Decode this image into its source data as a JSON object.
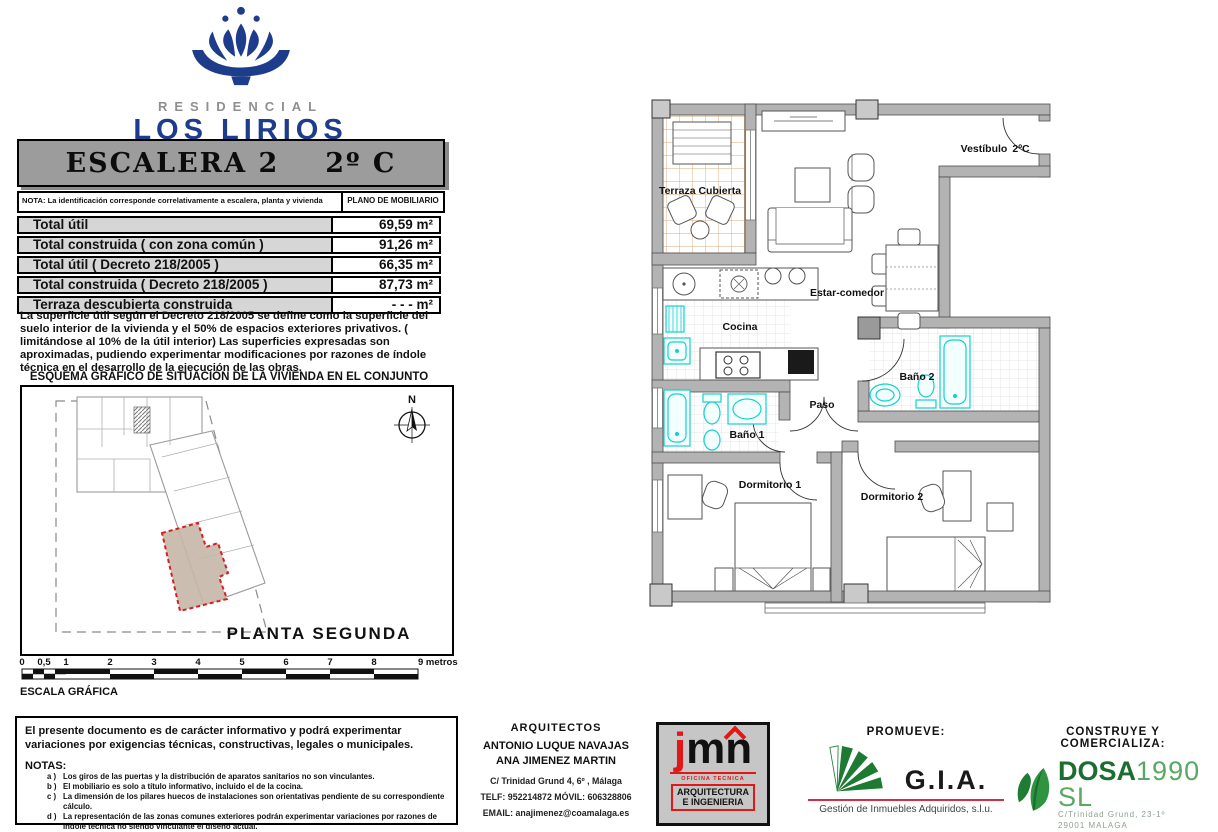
{
  "brand": {
    "line1": "RESIDENCIAL",
    "line2": "LOS LIRIOS"
  },
  "header": {
    "escalera": "ESCALERA 2",
    "unidad": "2º C"
  },
  "nota_bar": {
    "nota": "NOTA: La identificación corresponde correlativamente a escalera, planta y vivienda",
    "plano": "PLANO DE MOBILIARIO"
  },
  "areas": {
    "rows": [
      {
        "label": "Total útil",
        "value": "69,59 m²"
      },
      {
        "label": "Total construida  ( con zona común )",
        "value": "91,26 m²"
      },
      {
        "label": "Total útil  ( Decreto 218/2005 )",
        "value": "66,35 m²"
      },
      {
        "label": "Total construida  ( Decreto 218/2005 )",
        "value": "87,73 m²"
      },
      {
        "label": "Terraza descubierta construida",
        "value": "- - - m²"
      }
    ]
  },
  "description": "La superficie útil según el Decreto 218/2005 se define como la superficie del suelo interior de la vivienda y el 50% de espacios exteriores privativos.  ( limitándose al 10% de la útil interior)  Las superficies expresadas son aproximadas, pudiendo experimentar modificaciones por razones de índole técnica en el desarrollo de la ejecución de las obras.",
  "esquema": {
    "title": "ESQUEMA GRÁFICO DE SITUACIÓN DE LA VIVIENDA EN EL CONJUNTO",
    "planta": "PLANTA SEGUNDA",
    "north": "N"
  },
  "scale": {
    "labels": [
      "0",
      "0,5",
      "1",
      "2",
      "3",
      "4",
      "5",
      "6",
      "7",
      "8",
      "9 metros"
    ],
    "caption": "ESCALA GRÁFICA"
  },
  "disclaimer": {
    "intro": "El presente documento es de carácter informativo y podrá experimentar variaciones por exigencias técnicas, constructivas, legales o municipales.",
    "notas_title": "NOTAS:",
    "items": [
      {
        "id": "a )",
        "text": "Los giros de las puertas y la distribución de aparatos sanitarios no son vinculantes."
      },
      {
        "id": "b )",
        "text": "El mobiliario es solo a título informativo, incluido el de la cocina."
      },
      {
        "id": "c )",
        "text": "La dimensión de los pilares huecos de instalaciones son orientativas pendiente de su correspondiente cálculo."
      },
      {
        "id": "d )",
        "text": "La representación de las zonas comunes exteriores podrán experimentar variaciones por razones de índole técnica no siendo vinculante el diseño actual."
      }
    ]
  },
  "architects": {
    "title": "ARQUITECTOS",
    "name1": "ANTONIO LUQUE NAVAJAS",
    "name2": "ANA JIMENEZ MARTIN",
    "address": "C/ Trinidad Grund 4, 6º , Málaga",
    "phone": "TELF: 952214872   MÓVIL: 606328806",
    "email": "EMAIL: anajimenez@coamalaga.es"
  },
  "jmn": {
    "j": "j",
    "mn": "mn",
    "line1": "OFICINA  TECNICA",
    "line2": "ARQUITECTURA",
    "line3": "E INGENIERIA"
  },
  "promueve": {
    "title": "PROMUEVE:",
    "logo": "G.I.A.",
    "subtitle": "Gestión de Inmuebles Adquiridos, s.l.u."
  },
  "construye": {
    "title": "CONSTRUYE Y COMERCIALIZA:",
    "brand_bold": "DOSA",
    "brand_light": "1990 SL",
    "addr1": "C/Trinidad Grund, 23-1º",
    "addr2": "29001 MALAGA"
  },
  "floorplan": {
    "rooms": {
      "terraza": "Terraza Cubierta",
      "vestibulo": "Vestíbulo",
      "unidad": "2ºC",
      "estar": "Estar-comedor",
      "cocina": "Cocina",
      "bano1": "Baño 1",
      "bano2": "Baño 2",
      "paso": "Paso",
      "dorm1": "Dormitorio 1",
      "dorm2": "Dormitorio 2"
    }
  },
  "colors": {
    "navy": "#1e3c8c",
    "cyan": "#17cfcf",
    "wall": "#b3b3b3",
    "red": "#d42020",
    "green_gia": "#1d7a32",
    "green_dosa": "#1b6e2f",
    "green_dosa_light": "#5aa864",
    "tan_unit": "#c7b6a9"
  }
}
